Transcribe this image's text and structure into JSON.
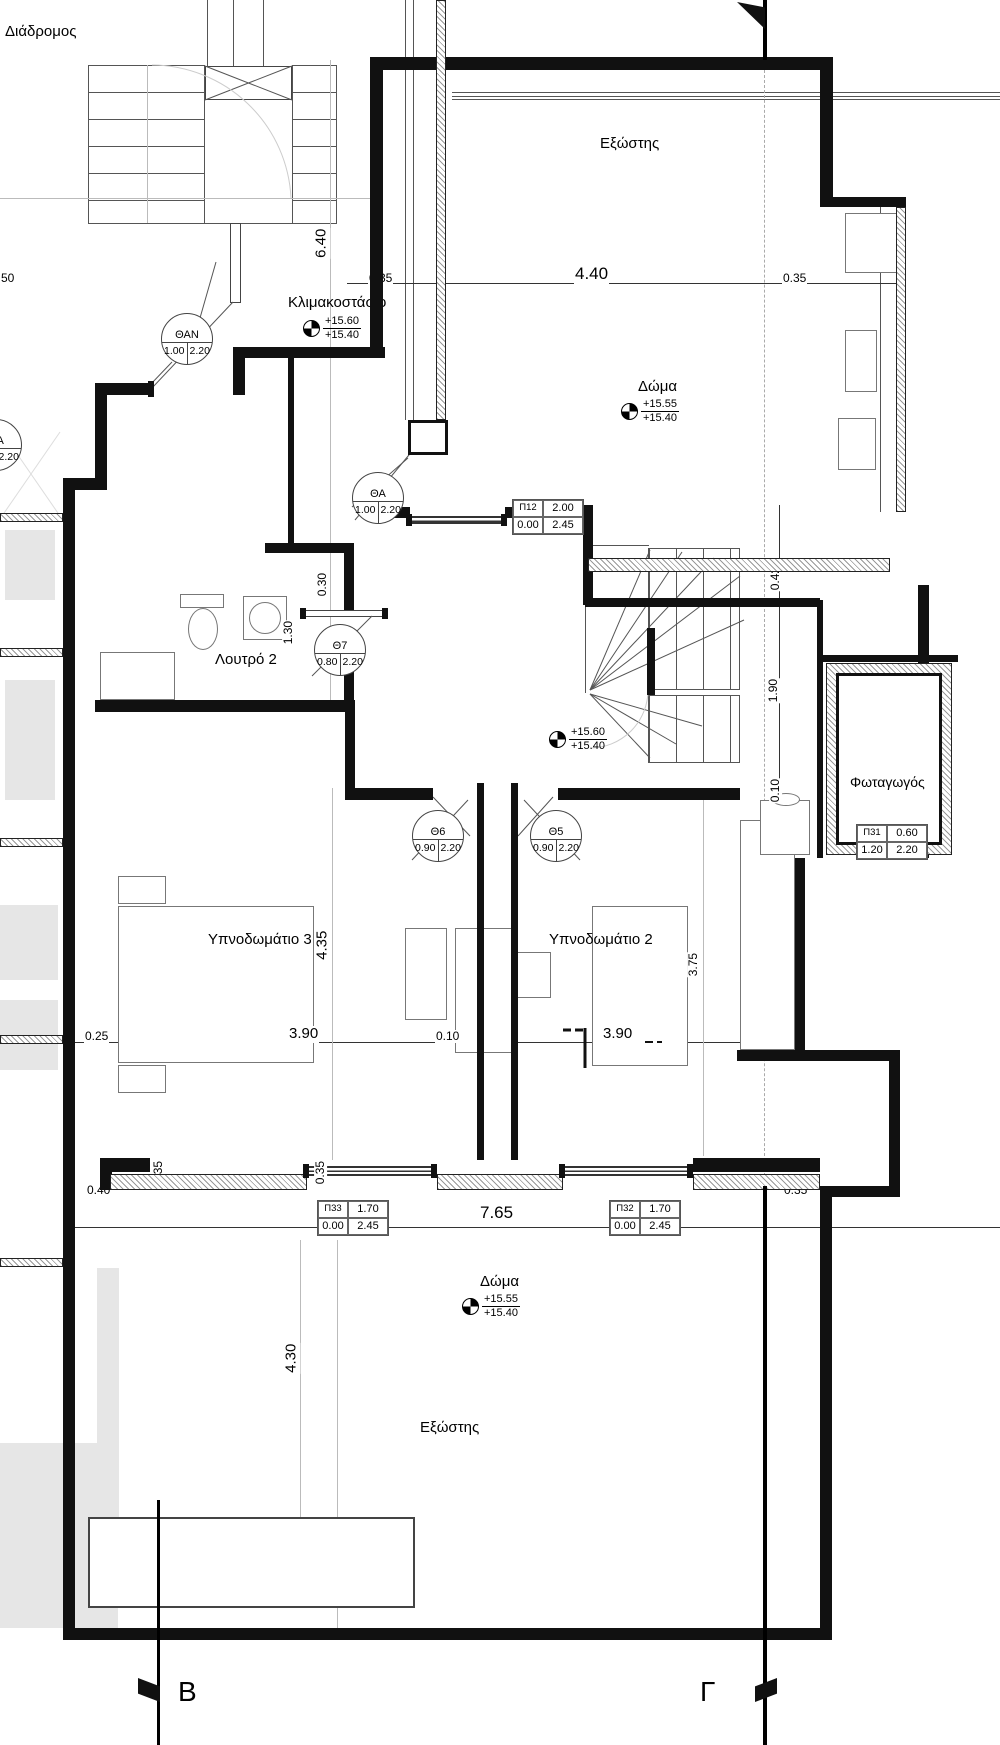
{
  "rooms": {
    "corridor": "Διάδρομος",
    "balcony_top": "Εξώστης",
    "roof_top": "Δώμα",
    "stairwell": "Κλιμακοστάσιο",
    "bathroom": "Λουτρό 2",
    "lightwell": "Φωταγωγός",
    "bedroom3": "Υπνοδωμάτιο 3",
    "bedroom2": "Υπνοδωμάτιο 2",
    "roof_bottom": "Δώμα",
    "balcony_bottom": "Εξώστης"
  },
  "levels": {
    "stairwell": {
      "top": "+15.60",
      "bottom": "+15.40"
    },
    "roof_top": {
      "top": "+15.55",
      "bottom": "+15.40"
    },
    "hall": {
      "top": "+15.60",
      "bottom": "+15.40"
    },
    "roof_bottom": {
      "top": "+15.55",
      "bottom": "+15.40"
    }
  },
  "door_tags": {
    "than": {
      "id": "ΘΑΝ",
      "w": "1.00",
      "h": "2.20"
    },
    "tha": {
      "id": "ΘΑ",
      "w": "1.00",
      "h": "2.20"
    },
    "th7": {
      "id": "Θ7",
      "w": "0.80",
      "h": "2.20"
    },
    "th6": {
      "id": "Θ6",
      "w": "0.90",
      "h": "2.20"
    },
    "th5": {
      "id": "Θ5",
      "w": "0.90",
      "h": "2.20"
    },
    "tha_edge": {
      "id": "ΘΑ",
      "w": "",
      "h": "2.20"
    }
  },
  "window_tags": {
    "p12": {
      "id": "Π12",
      "w": "2.00",
      "sill": "0.00",
      "h": "2.45"
    },
    "p31": {
      "id": "Π31",
      "w": "0.60",
      "sill": "1.20",
      "h": "2.20"
    },
    "p33": {
      "id": "Π33",
      "w": "1.70",
      "sill": "0.00",
      "h": "2.45"
    },
    "p32": {
      "id": "Π32",
      "w": "1.70",
      "sill": "0.00",
      "h": "2.45"
    }
  },
  "dims": {
    "top_left": "0.35",
    "top_mid": "4.40",
    "top_right": "0.35",
    "stair_height": "6.40",
    "wall_030": "0.30",
    "bath_130": "1.30",
    "right_042": "0.42",
    "right_190": "1.90",
    "right_010": "0.10",
    "mid_025": "0.25",
    "bed3_width": "3.90",
    "mid_010": "0.10",
    "bed2_width": "3.90",
    "bed3_height": "4.35",
    "bed2_height": "3.75",
    "low_left_035": "0.35",
    "low_mid_035": "0.35",
    "low_040": "0.40",
    "low_765": "7.65",
    "low_right_035": "0.35",
    "terrace_height": "4.30",
    "edge_50": "50"
  },
  "sections": {
    "b": "Β",
    "g": "Γ"
  }
}
